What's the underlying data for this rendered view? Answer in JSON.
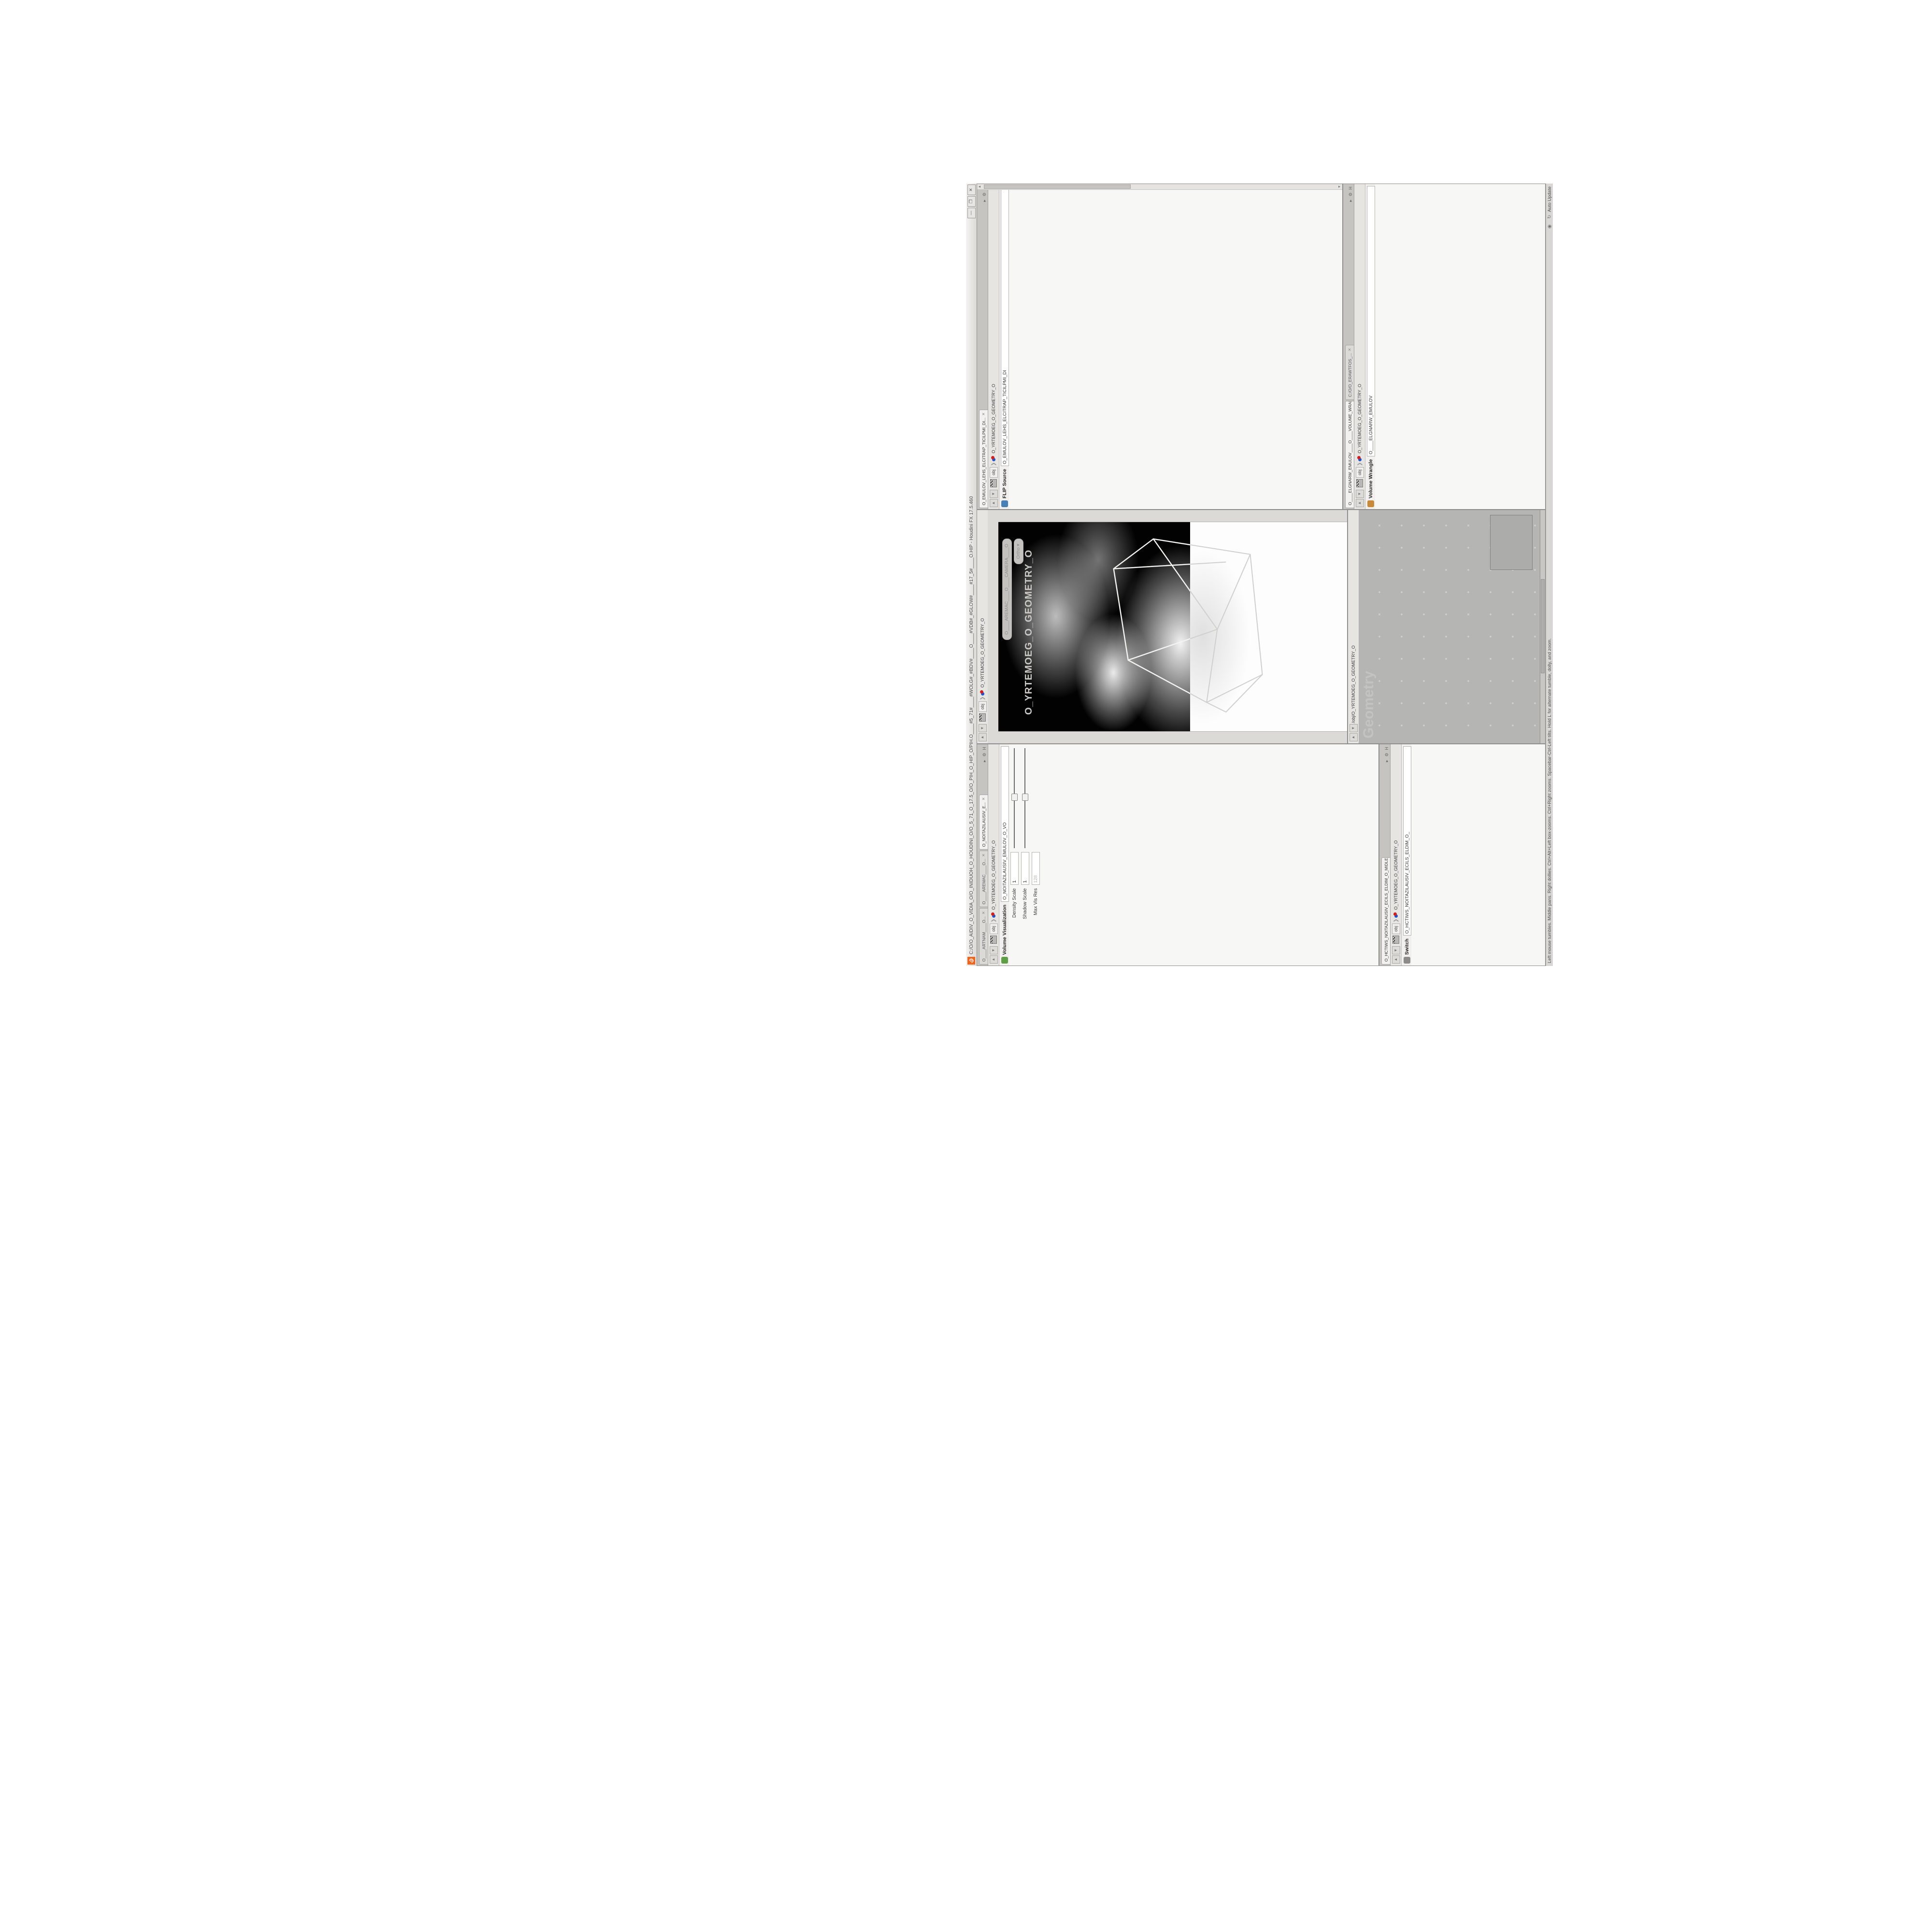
{
  "colors": {
    "accent_orange": "#f0641e",
    "yellow_field": "#fbf8cd",
    "wire_blue": "#5b79a5",
    "select_purple": "#b4a3e3",
    "select_blue": "#7d8fc1",
    "code_olive": "#8f9a2e",
    "network_bg": "#b5b5b3"
  },
  "titlebar": {
    "title": "C:/O/O_AIDIV_O_VIDIA_O/O_INIDUOH_O_HOUDINI_O/O_5_71_O_17.5_O/O_PIH_O_HIP_O/PIH.O____#5_71#____#WOLG#_#BDV#____O____#VDB#_#GLOW#____#17_5#____O.HIP - Houdini FX 17.5.460",
    "minimize": "—",
    "maximize": "❐",
    "close": "✕"
  },
  "statusbar": {
    "help": "Left mouse tumbles. Middle pans. Right dollies. Ctrl+Alt+Left box-zooms. Ctrl+Right zooms. Spacebar-Ctrl-Left tilts. Hold L for alternate tumble, dolly, and zoom.",
    "auto_update": "Auto Update"
  },
  "path": {
    "root": "obj",
    "geo": "O_YRTEMOEG_O_GEOMETRY_O",
    "net": "/obj/O_YRTEMOEG_O_GEOMETRY_O"
  },
  "viz": {
    "tabs": [
      "O____ARTNAM____O...",
      "O____AREMAC____O...",
      "O_NOITAZILAUSIV_E..."
    ],
    "selected_tab": 2,
    "header_title": "Volume Visualization",
    "header_name": "O_NOITAZILAUSIV_EMULOV_O_VO",
    "rows": [
      {
        "t": "field",
        "l": "Density Scale",
        "v": "1",
        "s": 0.5
      },
      {
        "t": "field",
        "l": "Shadow Scale",
        "v": "1",
        "s": 0.5
      },
      {
        "t": "field",
        "l": "Max Vis Res",
        "v": "128",
        "dis": true
      },
      {
        "t": "subtabs",
        "tabs": [
          "Smoke",
          "Emission"
        ],
        "sel": 0
      },
      {
        "t": "mono",
        "l": "Density Field",
        "v": "density"
      },
      {
        "t": "select",
        "l": "Mode",
        "v": "Clamped Ramp"
      },
      {
        "t": "ramp",
        "l": "Density Ramp",
        "h": 148,
        "presets": "Presets"
      },
      {
        "t": "mono",
        "l": "Diffuse Field",
        "v": "density"
      },
      {
        "t": "fields",
        "l": "Diffuse Range",
        "vs": [
          "0",
          "1"
        ],
        "dis": true
      },
      {
        "t": "select",
        "l": "Mode",
        "v": "Clamped Ramp"
      },
      {
        "t": "ramp",
        "l": "Diffuse Ramp",
        "h": 118,
        "presets": "Presets"
      },
      {
        "t": "field",
        "l": "Point No.",
        "v": "1"
      },
      {
        "t": "field",
        "l": "Position",
        "v": "0",
        "s": 0.04
      },
      {
        "t": "color",
        "l": "Color"
      },
      {
        "t": "select",
        "l": "Interpolation",
        "v": "Linear"
      },
      {
        "t": "fields",
        "l": "",
        "vs": [
          "1.8125",
          "1.8125",
          "1.8125"
        ]
      }
    ]
  },
  "switch": {
    "tabs": [
      "O_HCTIWS_NOITAZILAUSIV_ECILS_ELDIM_O_MIDLE_SLICE_VI..."
    ],
    "selected_tab": 0,
    "header_title": "Switch",
    "header_name": "O_HCTIWS_NOITAZILAUSIV_ECILS_ELDIM_O_",
    "rows": [
      {
        "t": "field",
        "l": "Select Input",
        "v": "0",
        "s": 0.04
      },
      {
        "t": "label",
        "l": "Input Operators (Drag/Drop to reorder)"
      },
      {
        "t": "list",
        "items": [
          "O_NOITAZILAUSIV_EMULOV_O_VOLUM...",
          "O_MROFSNART_ECILS_ELDIM_O_MIDL..."
        ]
      }
    ]
  },
  "viewport": {
    "watermark": "O_YRTEMOEG_O_GEOMETRY_O",
    "camera_pill": "O____AREMAC____O____CAMERA____O",
    "projection_pill": "Ortho ▾",
    "top_toolbar": [
      "view-pin-icon",
      "snapshot-icon",
      "camera-box-icon",
      "shade-icon",
      "wire-icon",
      "lights-icon",
      "grid-icon",
      "objects-icon",
      "points-icon",
      "normals-icon",
      "flipbook-icon",
      "export-icon",
      "info-icon",
      "help-icon"
    ],
    "left_toolbar": [
      "lamp-icon",
      "lamp-icon",
      "lamp-icon",
      "back-icon",
      "select-arrow-icon",
      "viewport-box-icon",
      "translate-gizmo-icon",
      "rotate-gizmo-icon",
      "scale-gizmo-icon",
      "cut-icon",
      "axis-icon",
      "snap-window-icon",
      "magnet-grid-icon",
      "magnet-point-icon",
      "magnet-curve-icon",
      "play-icon",
      "sheet-icon",
      "disc-icon"
    ],
    "right_toolbar": [
      "eye-icon",
      "quad-view-icon",
      "camera-icon",
      "pin-icon",
      "wire-shade-icon",
      "smooth-shade-icon",
      "ortho-icon",
      "mirror-icon",
      "light-icon",
      "headlight-icon",
      "fog-icon",
      "backface-icon"
    ]
  },
  "network": {
    "watermark": "Geometry",
    "nodes": [
      {
        "type": "File",
        "name": "_O_55SUNEG_O.SLDPRT.STEP.3DM.OBJ",
        "blue": true
      },
      {
        "type": "Switch",
        "name": "O_HCTIWS_YRTEMOEG_LANRETXE_LANRETNI_O_INTERNAL_EXTERNAL_GEOMETRY_SWITCH_O"
      },
      {
        "type": "Clip",
        "name": "O_EREHPS_EBUC_D_CUBE_SPHERE_O",
        "flag": true
      },
      {
        "type": "Clip",
        "name": "O_EMARFERIW_NOGYLOP_EREHPS_EBUC_O_CUBE_SPHERE_POLYGON_WIREFRAME_O",
        "flag": true
      },
      {
        "type": "FLIP Source",
        "name": "O_EMULOV_LEHS_ELCITRAP_TICILPMI_DIULF_O_FLUID_IMPLICIT_PARTICLE_SHEL_VOLUME_O",
        "ring": true,
        "flag": true
      },
      {
        "type": "VDB from Polygons",
        "name": "O_SNOGILOP_YRTEMOEG_MORF_EMULOV_BDV_O_VDB_VOLUME_FROM_GEOMETRY_POLYGONS_O"
      },
      {
        "type": "Volume Wrangle",
        "name": "O___ELGNARW_EMULOV___O___VOLUME_WRANGLE___O",
        "flag": true
      },
      {
        "type": "Volume Visualization",
        "name": "O_NOITAZILAUSIV_EMULOV_O_VOLUME_VISUALIZATION_O"
      },
      {
        "type": "Transform",
        "name": "O_MROFSNART_ECILS_ELDIM_O_MIDLE_SLICE_TRANSFORM_O",
        "flag": true
      },
      {
        "type": "Switch",
        "name": "O_HCTIWS_NOITAZILAUSIV_ECILS_ELDIM_O_MIDLE_SLICE_VISUALIZATION_SWITCH_O",
        "flag": true
      },
      {
        "type": "Merge",
        "name": "O_ECAFRUS_HTIW_EMULOV_EGREM_O_MERGE_VOLUME_WITH_SURFACE_O"
      },
      {
        "type": "Transform",
        "name": "O_MROFSNART_TLUSER_O_RESULT_TRANSFORM_O",
        "selected": true
      }
    ]
  },
  "flip": {
    "tabs": [
      "O_EMULOV_LEHS_ELCITRAP_TICILPMI_DI..."
    ],
    "selected_tab": 0,
    "header_title": "FLIP Source",
    "header_name": "O_EMULOV_LEHS_ELCITRAP_TICILPMI_DI",
    "rows": [
      {
        "t": "fields2",
        "l": "Asset Name and Path",
        "a": "flipsource",
        "b": "C:/O/O_ERAWTFOS_..."
      },
      {
        "t": "select",
        "l": "Initialize",
        "v": "Source FLIP"
      },
      {
        "t": "mono",
        "l": "Volume Name",
        "v": "density"
      },
      {
        "t": "yellow",
        "l": "Voxel Size",
        "v": "1/27",
        "s": 0.42
      },
      {
        "t": "field",
        "l": "Shell Thickness",
        "v": "3",
        "s": 0.56,
        "rev": true
      },
      {
        "t": "check",
        "l": "Output Fog",
        "chk": false
      },
      {
        "t": "field",
        "l": "Fog Boost",
        "v": "0",
        "dis": true,
        "s": 0.08
      },
      {
        "t": "section",
        "l": "Particles"
      },
      {
        "t": "check",
        "l": "Create Particles",
        "chk": false,
        "bold": true
      },
      {
        "t": "field",
        "l": "Particle Group",
        "v": "particles",
        "dis": true,
        "w": 110
      },
      {
        "t": "field",
        "l": "Particle Separation",
        "v": "1/9",
        "dis": true,
        "s": 0.35
      },
      {
        "t": "field",
        "l": "Jitter Seed",
        "v": "0",
        "dis": true,
        "s": 0.06
      },
      {
        "t": "field",
        "l": "Jitter Scale",
        "v": "0",
        "dis": true,
        "s": 0.06
      },
      {
        "t": "field",
        "l": "Oversampling",
        "v": "2",
        "dis": true,
        "s": 0.3
      },
      {
        "t": "field",
        "l": "Oversampling Bandwi...",
        "v": "1",
        "dis": true,
        "s": 0.18
      },
      {
        "t": "fields",
        "l": "Velocity",
        "vs": [
          "0",
          "0",
          "0"
        ],
        "dis": true
      },
      {
        "t": "check",
        "l": "Add Rest Attribute",
        "chk": false
      },
      {
        "t": "check",
        "l": "Dual Rest Attributes",
        "chk": true
      },
      {
        "t": "field",
        "l": "Rest Offset",
        "v": "0",
        "dis": true,
        "s": 0.06
      }
    ]
  },
  "wrangle": {
    "tabs": [
      "O____ELGNARW_EMULOV____O____VOLUME_WRANGL...",
      "C:/O/O_ERAWTFOS_..."
    ],
    "selected_tab": 0,
    "header_title": "Volume Wrangle",
    "header_name": "O____ELGNARW_EMULOV",
    "code": [
      {
        "c": "cmt",
        "t": "0D3%steserPym62%0D3%eziSym62%000.1D3%C62%000."
      },
      {
        "c": "cmt",
        "t": "\\\\\\\\"
      },
      {
        "c": "cmt",
        "t": "HTTP://MEMORYST◎MP.C◎M/graphtoy/#draw1%3Dtru"
      },
      {
        "c": "cmt",
        "t": "HTTP://MEMORYST◎MP.C◎M/graphtoy/#draw1%3Dtru"
      },
      {
        "c": "code",
        "t": "@density=(("
      },
      {
        "c": "code",
        "t": "    ((pow(("
      },
      {
        "c": "code",
        "t": "        1./ (1.-cla"
      },
      {
        "c": "cmt",
        "t": "0D3%steserPym62%0D3%eziSym62%000.1D3%C62%000."
      },
      {
        "c": "cmt",
        "t": "0D3%steserPym62%0D3%eziSym62%000.1D3%C62%000."
      },
      {
        "c": "cmt",
        "t": "\\\\\\\\"
      },
      {
        "c": "cmt",
        "t": "HTTP://MEMORYST◎MP.C◎M/graphtoy/#draw1%3Dtru"
      },
      {
        "c": "cmt",
        "t": "HTTP://MEMORYST◎MP.C◎M/graphtoy/#draw1%3Dtru"
      }
    ],
    "cursor_info": "Ln 209, Col 1",
    "rows": [
      {
        "t": "fields2",
        "l": "Asset Name and Path",
        "a": "volumewrangle",
        "b": "C:/O/O_ERAWTFOS_..."
      },
      {
        "t": "code",
        "l": ""
      },
      {
        "t": "info",
        "v": "Ln 209, Col 1"
      },
      {
        "t": "field",
        "l": "Volumes to Write to",
        "v": "*",
        "w": 56
      },
      {
        "t": "check",
        "l": "Enforce Prototypes",
        "chk": false
      },
      {
        "t": "field",
        "l": "O_REWOP_O_POWER...",
        "v": "6",
        "s": 0.45
      },
      {
        "t": "field",
        "l": "O_ELACS_O_SCALE_O",
        "v": "32",
        "s": 0.12
      },
      {
        "t": "field",
        "l": "O_TFIHS_O_SHIFT_O",
        "v": "1.4375",
        "s": 0.25
      }
    ]
  }
}
